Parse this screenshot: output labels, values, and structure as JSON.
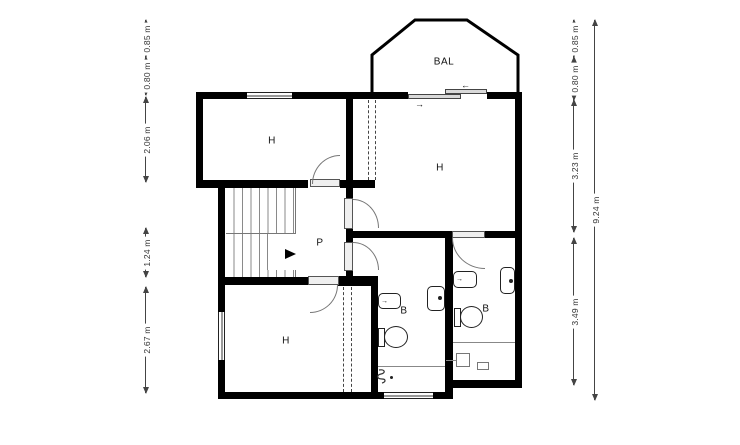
{
  "rooms": {
    "balcony": {
      "label": "BAL"
    },
    "bedroom_top_left": {
      "label": "H"
    },
    "bedroom_top_right": {
      "label": "H"
    },
    "bedroom_bottom_left": {
      "label": "H"
    },
    "hall": {
      "label": "P"
    },
    "bathroom_left": {
      "label": "B"
    },
    "bathroom_right": {
      "label": "B"
    }
  },
  "dimensions": {
    "left": [
      {
        "label": "0.85 m"
      },
      {
        "label": "0.80 m"
      },
      {
        "label": "2.06 m"
      },
      {
        "label": "1.24 m"
      },
      {
        "label": "2.67 m"
      }
    ],
    "right": [
      {
        "label": "0.85 m"
      },
      {
        "label": "0.80 m"
      },
      {
        "label": "3.23 m"
      },
      {
        "label": "3.49 m"
      }
    ],
    "right_total": {
      "label": "9.24 m"
    }
  },
  "icons": {
    "slide_left_arrow": "←",
    "slide_right_arrow": "→",
    "tap_arrow": "→"
  },
  "colors": {
    "wall": "#000000",
    "thin_line": "#555555",
    "background": "#ffffff"
  }
}
